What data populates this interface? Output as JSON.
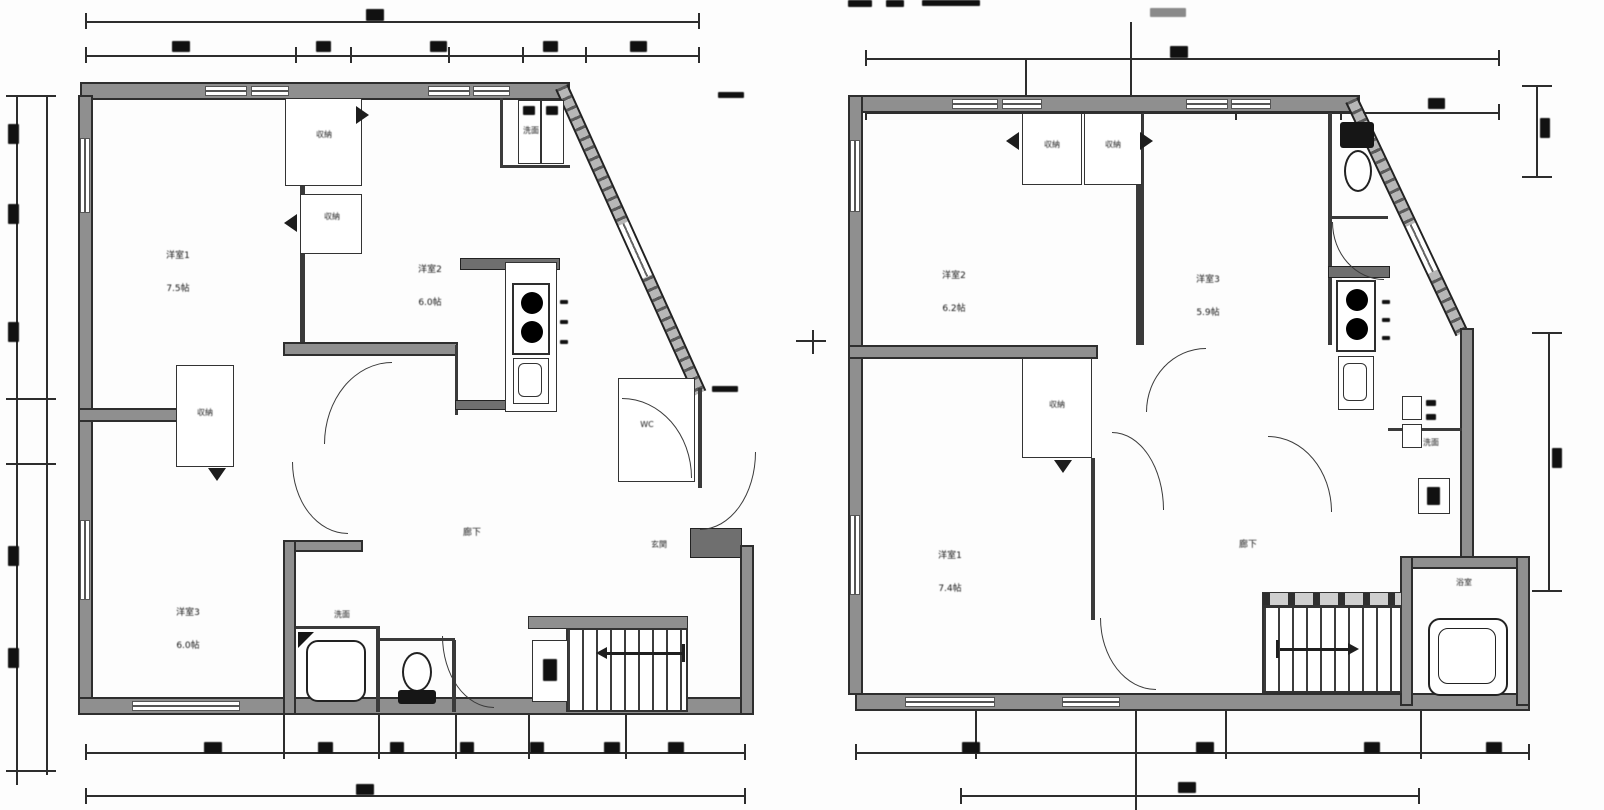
{
  "left_plan": {
    "rooms": {
      "room1": {
        "name": "洋室1",
        "area": "7.5帖"
      },
      "room2": {
        "name": "洋室2",
        "area": "6.0帖"
      },
      "room3": {
        "name": "洋室3",
        "area": "6.0帖"
      }
    },
    "hallway_label": "廊下",
    "entry_label": "玄関",
    "wc_label": "WC",
    "washroom_label": "洗面",
    "sanitary_label": "洗面",
    "closet1_label": "収納",
    "closet2_label": "収納",
    "closet3_label": "収納"
  },
  "right_plan": {
    "rooms": {
      "room1": {
        "name": "洋室1",
        "area": "7.4帖"
      },
      "room2": {
        "name": "洋室2",
        "area": "6.2帖"
      },
      "room3": {
        "name": "洋室3",
        "area": "5.9帖"
      }
    },
    "hall_label": "廊下",
    "wash_label": "洗面",
    "bath_label": "浴室",
    "closet1_label": "収納",
    "closet2_label": "収納",
    "closet3_label": "収納"
  },
  "colors": {
    "wall_fill": "#8f8f8f",
    "line": "#2e2e2e",
    "background": "#fdfdfd"
  }
}
